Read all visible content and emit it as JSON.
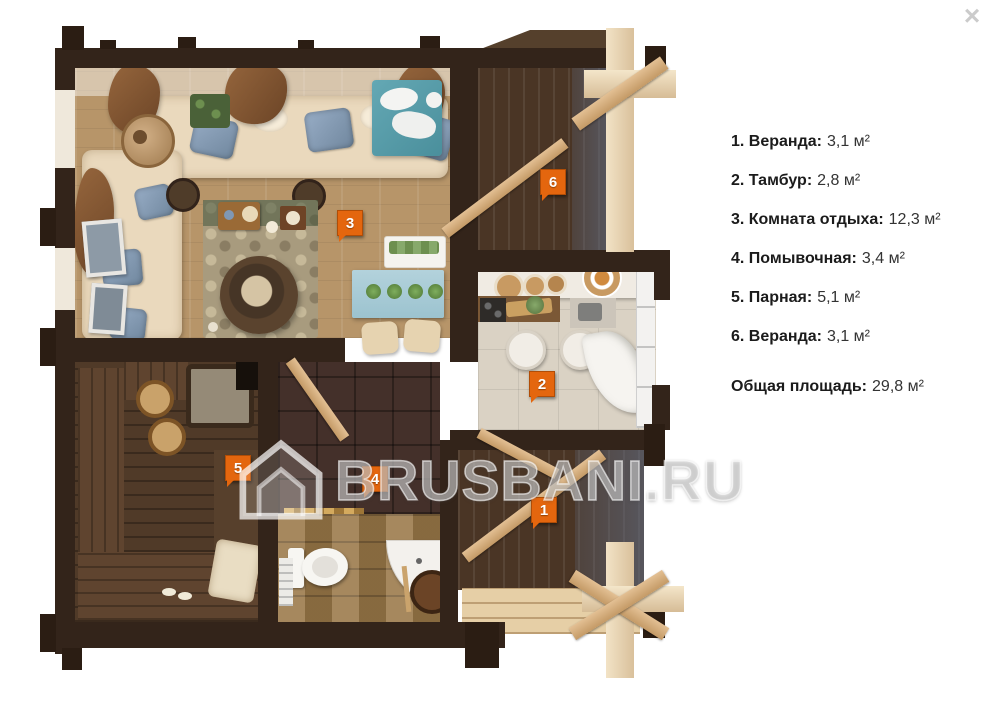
{
  "overlay": {
    "close_icon": "×"
  },
  "watermark": {
    "text": "BRUSBANI.RU",
    "logo": "house-icon"
  },
  "legend": {
    "items": [
      {
        "label": "1. Веранда:",
        "value": "3,1 м²"
      },
      {
        "label": "2. Тамбур:",
        "value": "2,8 м²"
      },
      {
        "label": "3. Комната отдыха:",
        "value": "12,3 м²"
      },
      {
        "label": "4. Помывочная:",
        "value": "3,4 м²"
      },
      {
        "label": "5. Парная:",
        "value": "5,1 м²"
      },
      {
        "label": "6. Веранда:",
        "value": "3,1 м²"
      }
    ],
    "total_label": "Общая площадь:",
    "total_value": "29,8 м²"
  },
  "floorplan": {
    "badges": [
      {
        "number": "1"
      },
      {
        "number": "2"
      },
      {
        "number": "3"
      },
      {
        "number": "4"
      },
      {
        "number": "5"
      },
      {
        "number": "6"
      }
    ],
    "badge_color": "#e4660e",
    "wall_color": "#33241a"
  }
}
